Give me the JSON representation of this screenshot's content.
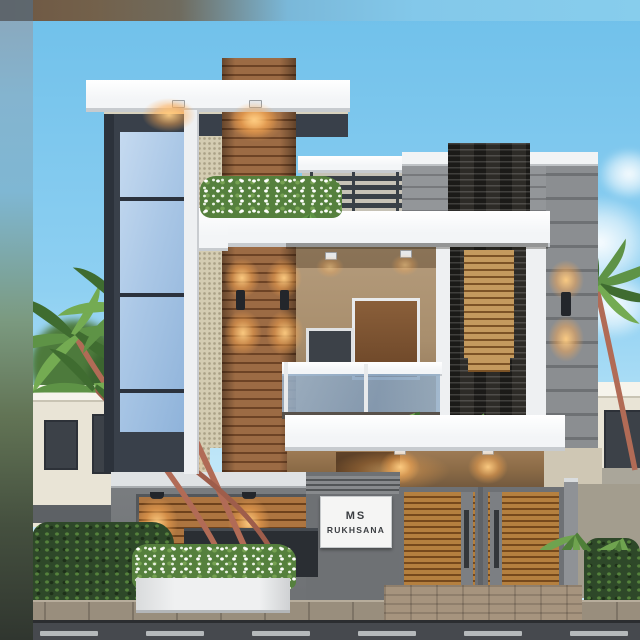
{
  "sign": {
    "line1": "MS",
    "line2": "RUKHSANA"
  },
  "palette": {
    "sky_top": "#6fc0ea",
    "sky_mid": "#8ed0f2",
    "sky_low": "#bfe6f8",
    "slab": "#f3f5f7",
    "slab_sh": "#c7cbcf",
    "charcoal": "#39404a",
    "charcoal_deep": "#2c323b",
    "wood": "#9c6b44",
    "wood_line": "#6d4325",
    "stucco": "#d4ccb2",
    "glass_a": "#c5daf0",
    "glass_b": "#8fb3da",
    "mullion": "#2b323d",
    "trim": "#eef0f2",
    "conc": "#8b8e91",
    "conc_line": "#6e7174",
    "par": "#939699",
    "par_line": "#77797c",
    "stone": "#2d2b27",
    "louver": "#c49a5e",
    "louver_line": "#7c5326",
    "int_tan": "#b09675",
    "int_dark": "#6d5236",
    "door": "#7c5434",
    "window": "#3c4148",
    "warm": "#ffc078",
    "rail": "#394047",
    "balc_glass": "#9db6cf",
    "hedge": "#2e4829",
    "hedge_hi": "#55823c",
    "palm": "#5e9346",
    "palm_dk": "#3f6c30",
    "trunk": "#b16b56",
    "nb_house": "#e9e4d6",
    "nb_band": "#5d6165",
    "wall": "#7b7e81",
    "wall_coping": "#dfe2e4",
    "sign_wall": "#6e7174",
    "slatp": "#ad7540",
    "slatp_line": "#6e421c",
    "gate_frame": "#6e7175",
    "gate_wood": "#b5803f",
    "gate_wood_line": "#76491c",
    "gate_handle": "#33363a",
    "planter": "#eff0f1",
    "planter_dk": "#2a2e33",
    "flower_green": "#55803d",
    "pave": "#998e7d",
    "brick": "#a6947e",
    "road": "#46494e",
    "road_line": "#c9cccf",
    "sign_bg": "#f5f5f4",
    "sign_text": "#3b3e42"
  }
}
